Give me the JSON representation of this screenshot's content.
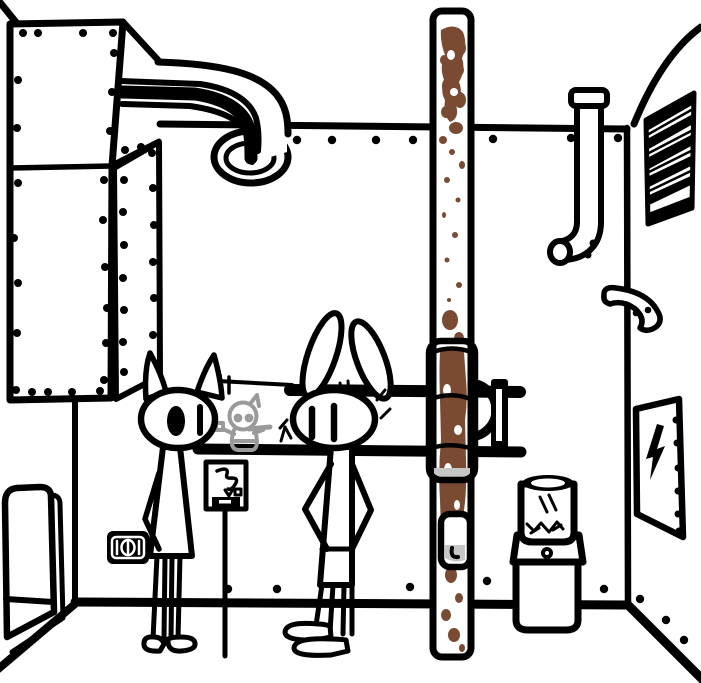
{
  "scene": {
    "description": "Hand-drawn black-outline cartoon of an industrial back room with two animal characters",
    "colors": {
      "ink": "#000000",
      "paper": "#ffffff",
      "duct_stripe": "#6d75e6",
      "rust": "#7b4a32",
      "sketch_gray": "#9a9a9a",
      "ring_gray": "#ababab",
      "shade_gray": "#c6c6c6"
    },
    "characters": [
      {
        "id": "cat",
        "description": "cat figure, pointed ears, filled oval left eye, line right eye, arms down"
      },
      {
        "id": "rabbit",
        "description": "rabbit figure, long splayed ears, hands on hips, feet pointing left"
      },
      {
        "id": "sketch",
        "description": "gray scribbled figure behind counter window holding a stick"
      }
    ],
    "objects": [
      {
        "id": "riveted-machine",
        "description": "large riveted sheet-metal cabinet, top left"
      },
      {
        "id": "duct",
        "description": "curved duct with blue stripe entering a round port"
      },
      {
        "id": "rusty-pipe",
        "description": "floor-to-ceiling rusty pipe with sleeve coupling and handle slot"
      },
      {
        "id": "counter-window",
        "description": "long wall opening with thick ledge and end cap"
      },
      {
        "id": "poster",
        "description": "small sign with scribble, tiny square, black label bar"
      },
      {
        "id": "outlet",
        "description": "black wall power outlet"
      },
      {
        "id": "right-pipe",
        "description": "capped downpipe ending in open elbow"
      },
      {
        "id": "elbow-fitting",
        "description": "loose curved pipe fitting on corner wall"
      },
      {
        "id": "vent",
        "description": "slatted louver vent, top right"
      },
      {
        "id": "electrical-panel",
        "description": "panel door with lightning bolt and screw dots"
      },
      {
        "id": "water-cooler",
        "description": "water cooler with bottle on top"
      },
      {
        "id": "door-panel",
        "description": "rounded door panel, bottom left"
      }
    ]
  }
}
